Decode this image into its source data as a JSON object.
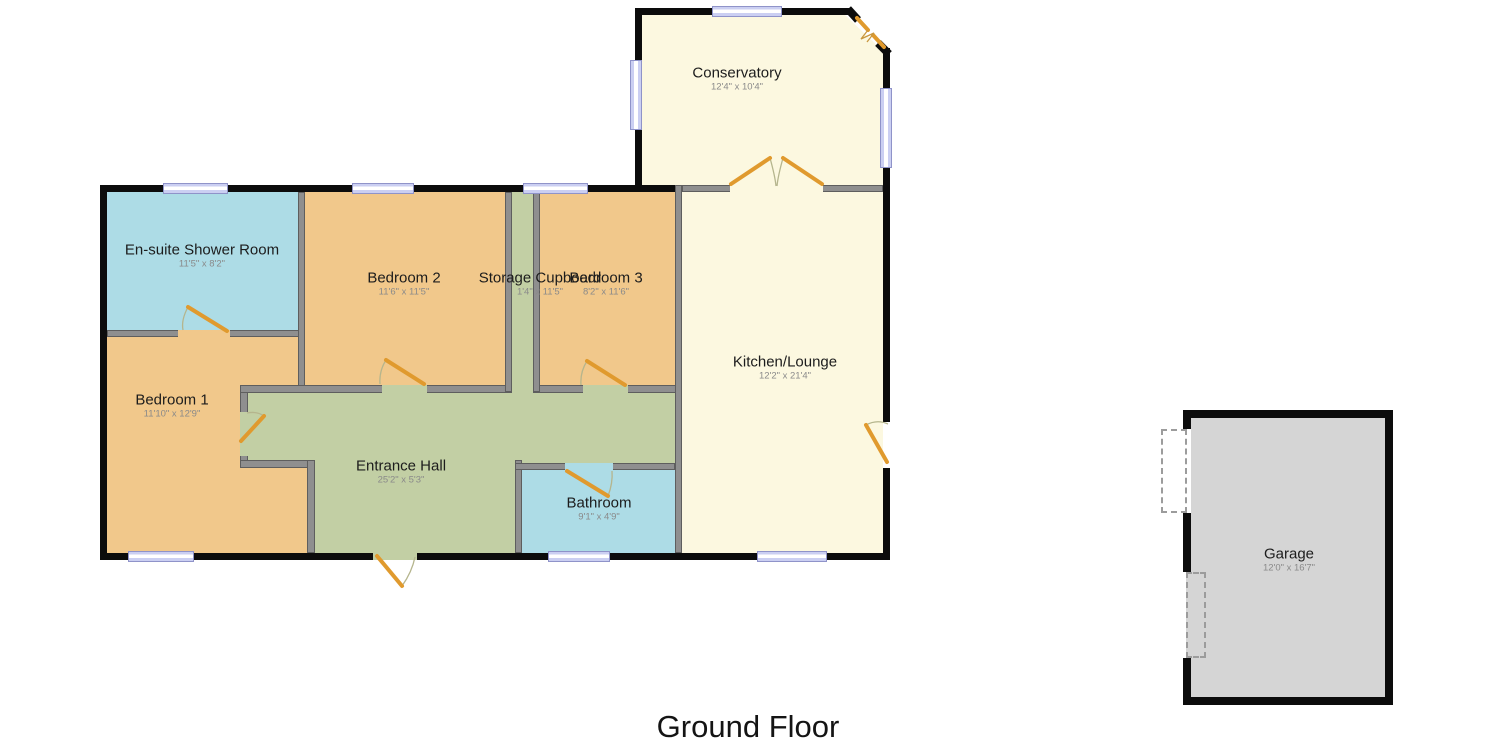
{
  "floor_title": "Ground Floor",
  "rooms": [
    {
      "name": "Conservatory",
      "dims": "12'4\" x 10'4\""
    },
    {
      "name": "En-suite Shower Room",
      "dims": "11'5\" x 8'2\""
    },
    {
      "name": "Bedroom 2",
      "dims": "11'6\" x 11'5\""
    },
    {
      "name": "Storage Cupboard",
      "dims": "1'4\" x 11'5\""
    },
    {
      "name": "Bedroom 3",
      "dims": "8'2\" x 11'6\""
    },
    {
      "name": "Bedroom 1",
      "dims": "11'10\" x 12'9\""
    },
    {
      "name": "Entrance Hall",
      "dims": "25'2\" x 5'3\""
    },
    {
      "name": "Bathroom",
      "dims": "9'1\" x 4'9\""
    },
    {
      "name": "Kitchen/Lounge",
      "dims": "12'2\" x 21'4\""
    },
    {
      "name": "Garage",
      "dims": "12'0\" x 16'7\""
    }
  ],
  "colors": {
    "room_orange": "#f1c88b",
    "room_cream": "#fcf8e0",
    "room_green": "#c2cfa4",
    "room_blue": "#addce6",
    "room_gray": "#d5d5d5",
    "wall_black": "#0c0c0c",
    "wall_gray": "#8f8f8f",
    "wall_gray_edge": "#5e5e5e",
    "window_fill": "#cbcff2",
    "window_border": "#8f93c9",
    "door": "#e09a2e",
    "swing_arc": "#b5b58d",
    "text_dark": "#1c1c1c",
    "text_dim": "#8a8a8a"
  }
}
